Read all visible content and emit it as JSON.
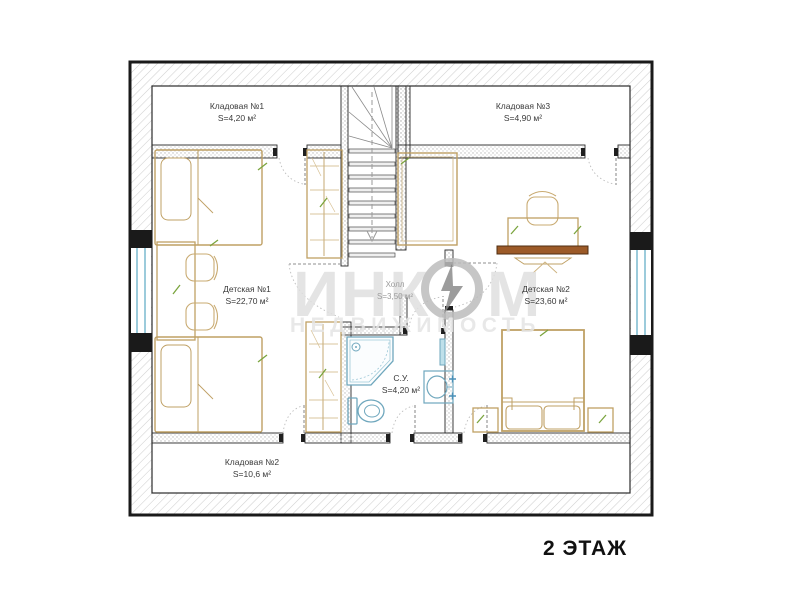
{
  "floor_label": "2 ЭТАЖ",
  "rooms": {
    "kladovaya1": {
      "name": "Кладовая №1",
      "area": "S=4,20 м²"
    },
    "kladovaya2": {
      "name": "Кладовая №2",
      "area": "S=10,6 м²"
    },
    "kladovaya3": {
      "name": "Кладовая №3",
      "area": "S=4,90 м²"
    },
    "detskaya1": {
      "name": "Детская №1",
      "area": "S=22,70 м²"
    },
    "detskaya2": {
      "name": "Детская №2",
      "area": "S=23,60 м²"
    },
    "holl": {
      "name": "Холл",
      "area": "S=3,50 м²"
    },
    "su": {
      "name": "С.У.",
      "area": "S=4,20 м²"
    }
  },
  "watermark": {
    "brand_prefix": "ИНК",
    "brand_suffix": "М",
    "subtitle": "НЕДВИЖИМОСТЬ"
  },
  "palette": {
    "wall_line": "#2b2b2b",
    "hatch_gray": "#cfcfcf",
    "furniture_tan": "#bfa064",
    "plumbing_blue": "#6fa7bd",
    "window_blue": "#9ccbdb",
    "wood_brown": "#9c5a28",
    "accent_green": "#7aa43d",
    "label_gray": "#3a3a3a",
    "watermark_gray": "#e0e0e0"
  }
}
